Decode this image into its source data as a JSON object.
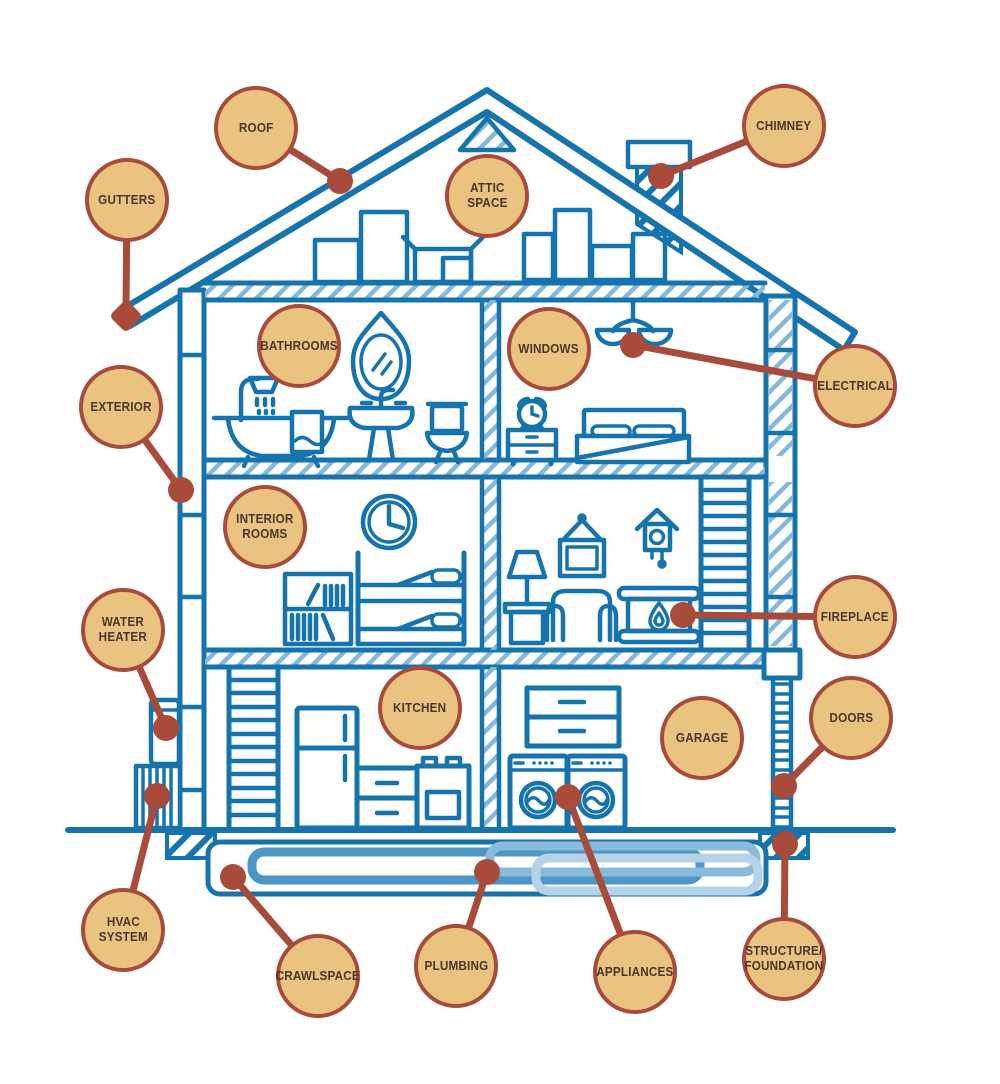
{
  "diagram": {
    "callouts": [
      {
        "id": "roof",
        "label": "ROOF"
      },
      {
        "id": "chimney",
        "label": "CHIMNEY"
      },
      {
        "id": "gutters",
        "label": "GUTTERS"
      },
      {
        "id": "attic-space",
        "label": "ATTIC\nSPACE"
      },
      {
        "id": "bathrooms",
        "label": "BATHROOMS"
      },
      {
        "id": "windows",
        "label": "WINDOWS"
      },
      {
        "id": "electrical",
        "label": "ELECTRICAL"
      },
      {
        "id": "exterior",
        "label": "EXTERIOR"
      },
      {
        "id": "interior-rooms",
        "label": "INTERIOR\nROOMS"
      },
      {
        "id": "fireplace",
        "label": "FIREPLACE"
      },
      {
        "id": "water-heater",
        "label": "WATER\nHEATER"
      },
      {
        "id": "kitchen",
        "label": "KITCHEN"
      },
      {
        "id": "garage",
        "label": "GARAGE"
      },
      {
        "id": "doors",
        "label": "DOORS"
      },
      {
        "id": "hvac-system",
        "label": "HVAC\nSYSTEM"
      },
      {
        "id": "crawlspace",
        "label": "CRAWLSPACE"
      },
      {
        "id": "plumbing",
        "label": "PLUMBING"
      },
      {
        "id": "appliances",
        "label": "APPLIANCES"
      },
      {
        "id": "structure-foundation",
        "label": "STRUCTURE/\nFOUNDATION"
      }
    ],
    "colors": {
      "house_line": "#1573AE",
      "hatch_light": "#85B8DA",
      "callout_fill": "#EBC381",
      "callout_border": "#A84B3A",
      "label_text": "#4A362C",
      "pipe_medium": "#4E96C5",
      "pipe_light": "#8BBBDC",
      "pipe_lighter": "#B5D3E8"
    },
    "illustration_icons": [
      "roof",
      "gutter-corner",
      "chimney",
      "attic-boxes",
      "bathtub",
      "shower-head",
      "towel",
      "mirror",
      "pedestal-sink",
      "toilet",
      "chandelier",
      "alarm-clock",
      "nightstand",
      "bed",
      "wall-clock",
      "bookshelf",
      "bunk-bed",
      "floor-lamp",
      "picture-frame",
      "cuckoo-clock",
      "armchair",
      "fireplace",
      "staircase-upper",
      "staircase-lower",
      "refrigerator",
      "kitchen-cabinet",
      "stove",
      "garage-cabinet",
      "washer",
      "dryer",
      "garage-door",
      "water-heater-tank",
      "hvac-unit",
      "foundation-blocks",
      "ground-line",
      "crawlspace",
      "plumbing-pipes"
    ]
  }
}
